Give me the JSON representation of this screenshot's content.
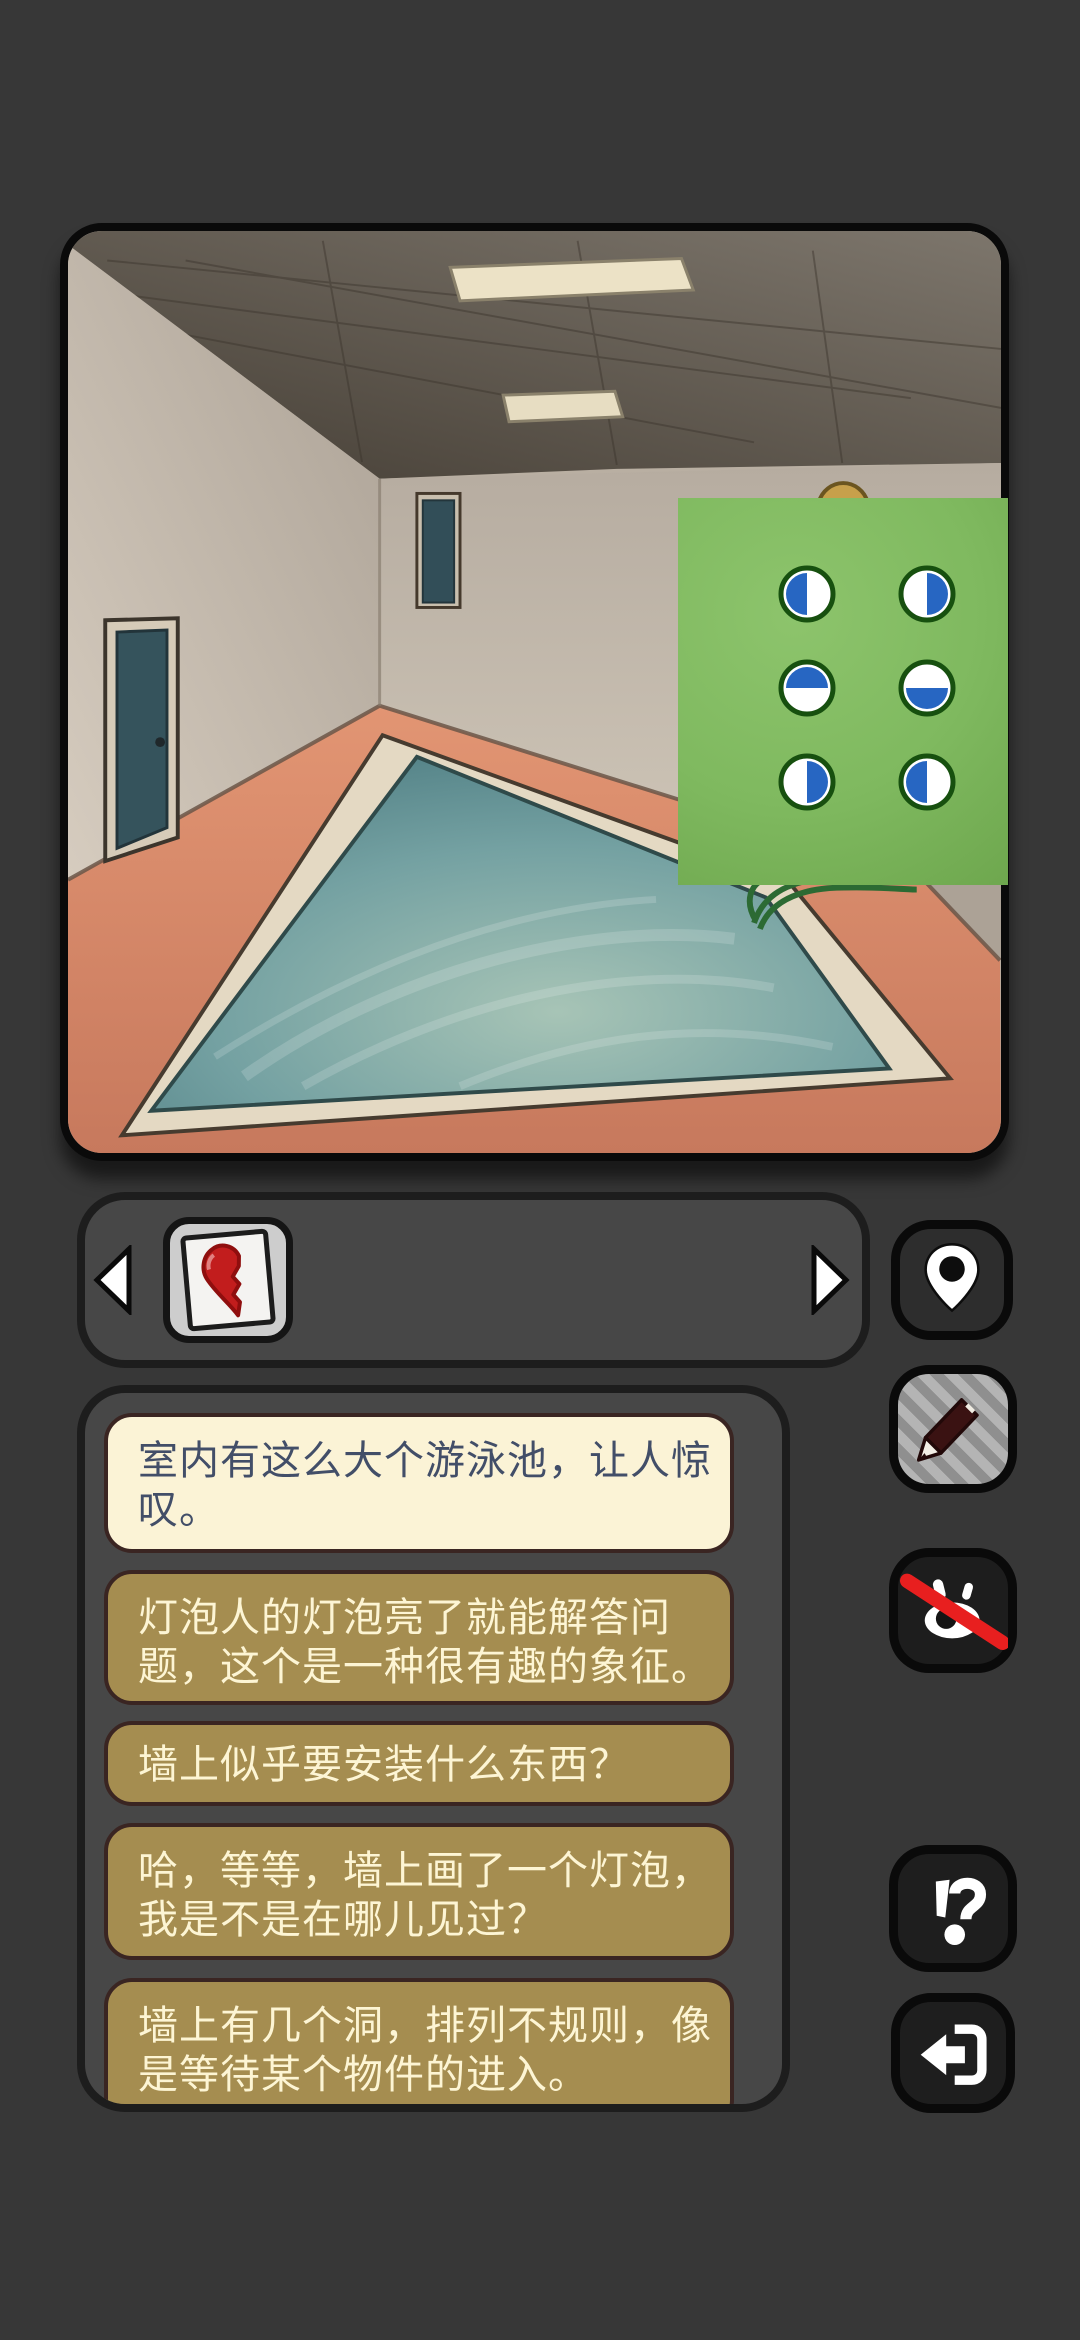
{
  "app": {
    "title": "escape-room puzzle game screen",
    "background_color": "#373737"
  },
  "colors": {
    "bg": "#373737",
    "panel-bg": "#474747",
    "panel-border": "#1d1d1d",
    "bubble-cream": "#fbf3d6",
    "bubble-cream-text": "#424e68",
    "bubble-border": "#3a2522",
    "bubble-khaki": "#a58d50",
    "bubble-khaki-text": "#fdf5d4",
    "green-panel": "#7fb95f",
    "token-blue": "#2766c2",
    "token-ring": "#17500f",
    "btn-dark": "#1e1e1e",
    "btn-border": "#0a0a0a",
    "slash-red": "#e81f1f",
    "pool-water": "#6c98a0",
    "pool-coping": "#e4d9c3",
    "floor-salmon": "#dd8a6c",
    "wall-beige": "#c9bfb1",
    "ceiling-gray": "#5c554b",
    "heart-red": "#c21d1d",
    "duck-gold": "#c7a04b"
  },
  "scene": {
    "name": "indoor-pool-room",
    "objects": [
      "concrete ceiling with two recessed lights",
      "left wall door",
      "back wall door",
      "large swimming pool with teal water and cream coping",
      "salmon tiled floor",
      "golden duck behind puzzle panel",
      "green rope on pool edge"
    ]
  },
  "puzzle": {
    "name": "half-circle-code-panel",
    "panel_color": "#7fb95f",
    "circle_fill": "#ffffff",
    "half_color": "#2766c2",
    "ring_color": "#17500f",
    "circles": [
      {
        "row": 1,
        "col": 1,
        "half": "left"
      },
      {
        "row": 1,
        "col": 2,
        "half": "right"
      },
      {
        "row": 2,
        "col": 1,
        "half": "top"
      },
      {
        "row": 2,
        "col": 2,
        "half": "bottom"
      },
      {
        "row": 3,
        "col": 1,
        "half": "right"
      },
      {
        "row": 3,
        "col": 2,
        "half": "left"
      }
    ]
  },
  "inventory": {
    "prev_icon": "arrow-left-icon",
    "next_icon": "arrow-right-icon",
    "items": [
      {
        "name": "half-heart-card",
        "icon": "half-heart-item-icon",
        "color": "#c21d1d"
      }
    ]
  },
  "side_buttons": [
    {
      "name": "location",
      "icon": "map-pin-icon"
    },
    {
      "name": "edit-note",
      "icon": "pencil-icon",
      "state": "highlighted"
    },
    {
      "name": "hide-highlights",
      "icon": "eye-off-icon",
      "slash_color": "#e81f1f"
    },
    {
      "name": "hint",
      "icon": "interrobang-icon",
      "glyph": "!?"
    },
    {
      "name": "exit",
      "icon": "exit-arrow-icon"
    }
  ],
  "chat": {
    "bubbles": [
      {
        "type": "cream",
        "full_text": "室内有这么大个游泳池，让人惊叹。",
        "lines": [
          "室内有这么大个游泳池，让人惊",
          "叹。"
        ]
      },
      {
        "type": "khaki",
        "full_text": "灯泡人的灯泡亮了就能解答问题，这个是一种很有趣的象征。",
        "lines": [
          "灯泡人的灯泡亮了就能解答问",
          "题，这个是一种很有趣的象征。"
        ]
      },
      {
        "type": "khaki",
        "full_text": "墙上似乎要安装什么东西？",
        "lines": [
          "墙上似乎要安装什么东西？"
        ]
      },
      {
        "type": "khaki",
        "full_text": "哈，等等，墙上画了一个灯泡，我是不是在哪儿见过？",
        "lines": [
          "哈，等等，墙上画了一个灯泡，",
          "我是不是在哪儿见过？"
        ]
      },
      {
        "type": "khaki",
        "full_text": "墙上有几个洞，排列不规则，像是等待某个物件的进入。",
        "lines": [
          "墙上有几个洞，排列不规则，像",
          "是等待某个物件的进入。"
        ]
      }
    ]
  }
}
